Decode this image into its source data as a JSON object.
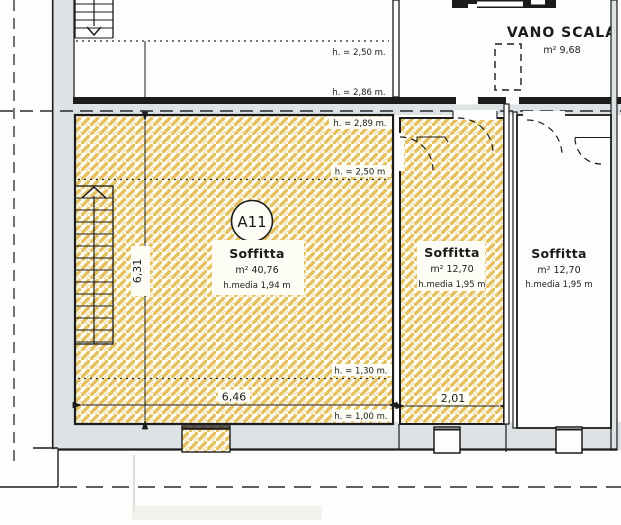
{
  "colors": {
    "hatch_yellow": "#e4c05e",
    "wall_fill": "#dde3e4",
    "line_black": "#1c1c1c",
    "paper": "#fdfdfb"
  },
  "upper_room": {
    "height_1": "h. = 2,50 m.",
    "height_2": "h. = 2,86 m."
  },
  "vano_scala": {
    "title": "VANO SCALA",
    "area": "m² 9,68"
  },
  "room_a11": {
    "badge": "A11",
    "name": "Soffitta",
    "area": "m² 40,76",
    "avg_height": "h.media 1,94 m",
    "height_top": "h. = 2,89 m.",
    "height_mid": "h. = 2,50 m",
    "height_low": "h. = 1,30 m.",
    "height_floor": "h. = 1,00 m.",
    "width": "6,46",
    "depth": "6,31"
  },
  "room_center": {
    "name": "Soffitta",
    "area": "m² 12,70",
    "avg_height": "h.media 1,95 m",
    "width": "2,01"
  },
  "room_right": {
    "name": "Soffitta",
    "area": "m² 12,70",
    "avg_height": "h.media 1,95 m"
  }
}
